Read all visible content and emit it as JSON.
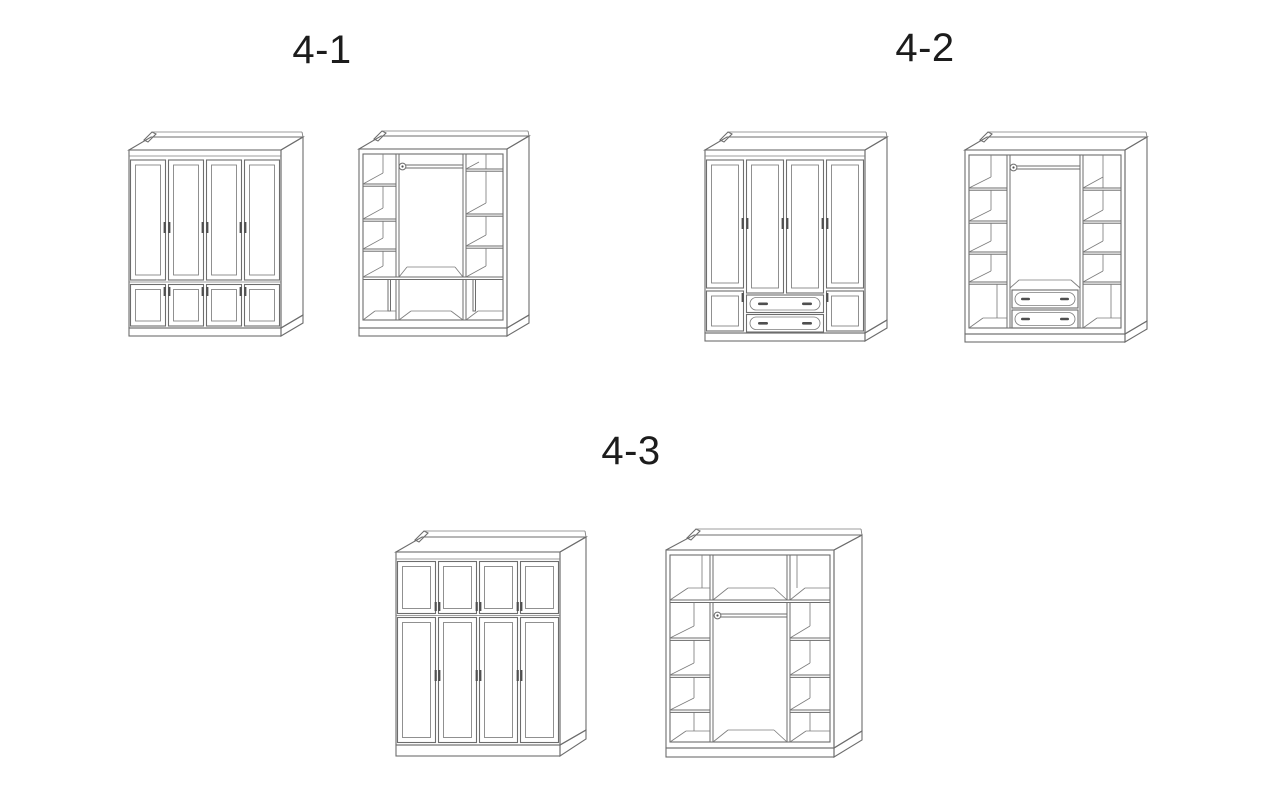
{
  "page": {
    "background": "#ffffff",
    "line_color": "#6d6d6d",
    "handle_color": "#4f4f4f",
    "label_color": "#1c1c1c"
  },
  "groups": [
    {
      "label": "4-1",
      "figures": [
        {
          "name": "wardrobe-4-1-exterior",
          "icon": "wardrobe-four-door-lower-doors-closed-icon"
        },
        {
          "name": "wardrobe-4-1-interior",
          "icon": "wardrobe-open-side-shelves-hanging-rod-icon"
        }
      ]
    },
    {
      "label": "4-2",
      "figures": [
        {
          "name": "wardrobe-4-2-exterior",
          "icon": "wardrobe-four-door-two-drawer-closed-icon"
        },
        {
          "name": "wardrobe-4-2-interior",
          "icon": "wardrobe-open-side-shelves-rod-drawers-icon"
        }
      ]
    },
    {
      "label": "4-3",
      "figures": [
        {
          "name": "wardrobe-4-3-exterior",
          "icon": "wardrobe-four-door-top-cabinets-closed-icon"
        },
        {
          "name": "wardrobe-4-3-interior",
          "icon": "wardrobe-open-top-shelf-rod-shelves-icon"
        }
      ]
    }
  ]
}
